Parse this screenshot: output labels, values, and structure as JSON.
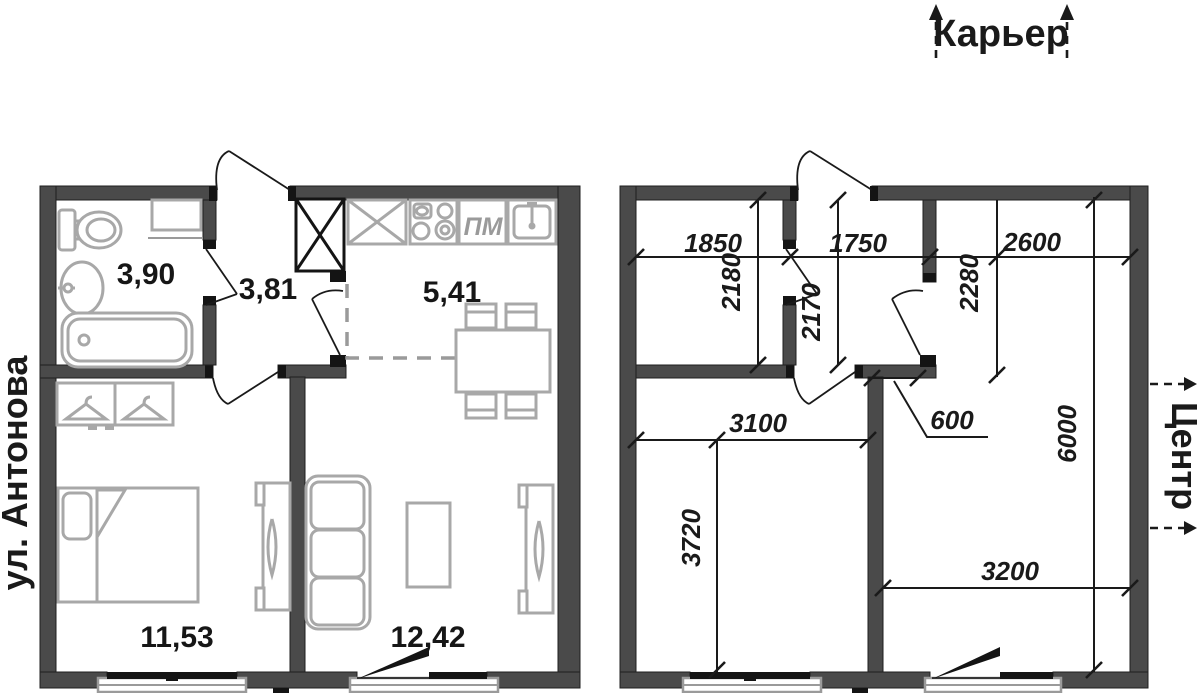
{
  "orientation": {
    "top_label": "Карьер",
    "left_label": "ул. Антонова",
    "right_label": "Центр"
  },
  "furnished_plan": {
    "areas": {
      "bathroom": "3,90",
      "hallway": "3,81",
      "kitchen": "5,41",
      "bedroom": "11,53",
      "living_room": "12,42"
    },
    "appliances": {
      "dishwasher": "ПМ"
    }
  },
  "dimension_plan": {
    "bathroom_width": "1850",
    "hallway_width": "1750",
    "kitchen_width": "2600",
    "bathroom_depth": "2180",
    "hallway_depth": "2170",
    "kitchen_depth": "2280",
    "bedroom_width": "3100",
    "wall_segment": "600",
    "bedroom_depth": "3720",
    "living_width": "3200",
    "total_depth": "6000"
  },
  "colors": {
    "wall": "#4a4a4a",
    "detail_black": "#141414",
    "furniture": "#a8a8a8",
    "text": "#1a1a1a",
    "background": "#ffffff"
  }
}
